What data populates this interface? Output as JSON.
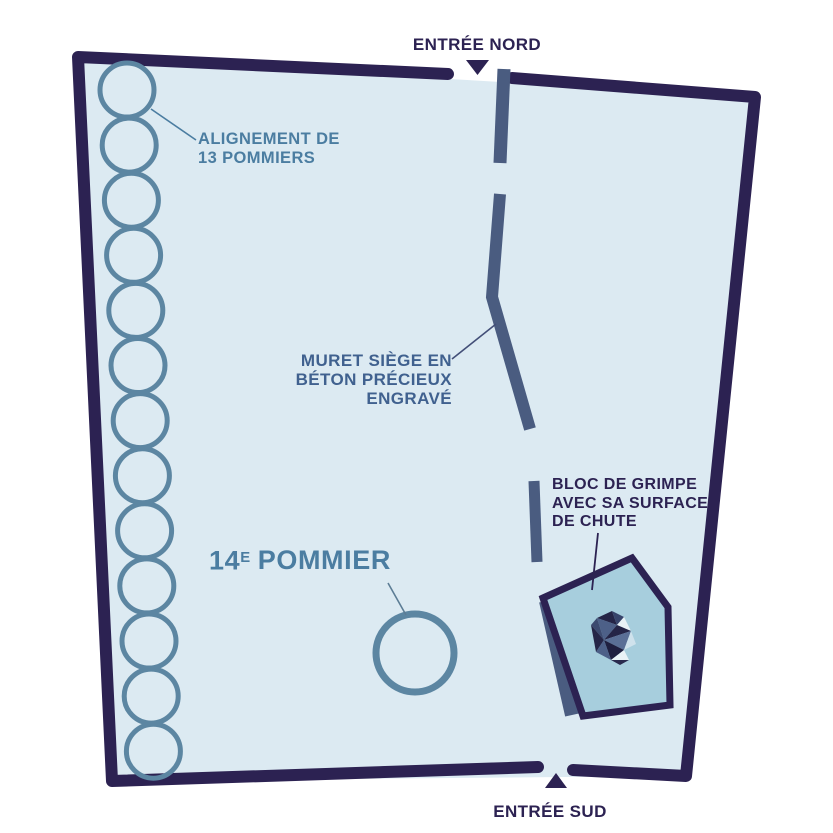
{
  "diagram": {
    "type": "park-site-plan",
    "labels": {
      "entrance_north": "ENTRÉE NORD",
      "entrance_south": "ENTRÉE SUD",
      "tree_row": {
        "line1": "ALIGNEMENT DE",
        "line2": "13 POMMIERS"
      },
      "seat_wall": {
        "line1": "MURET SIÈGE EN",
        "line2": "BÉTON PRÉCIEUX",
        "line3": "ENGRAVÉ"
      },
      "tree_14": {
        "number": "14",
        "ordinal": "E",
        "name": "POMMIER"
      },
      "climbing_block": {
        "line1": "BLOC DE GRIMPE",
        "line2": "AVEC SA SURFACE",
        "line3": "DE CHUTE"
      }
    },
    "tree_row": {
      "count": 13
    },
    "colors": {
      "background": "#ffffff",
      "park_fill": "#dceaf2",
      "boundary": "#2c2252",
      "wall": "#4a5c80",
      "tree_stroke": "#5c86a2",
      "steel_text": "#4b7da1",
      "slate_text": "#40618f",
      "navy_text": "#2c2252",
      "pad_fill": "#a7cedd"
    }
  }
}
